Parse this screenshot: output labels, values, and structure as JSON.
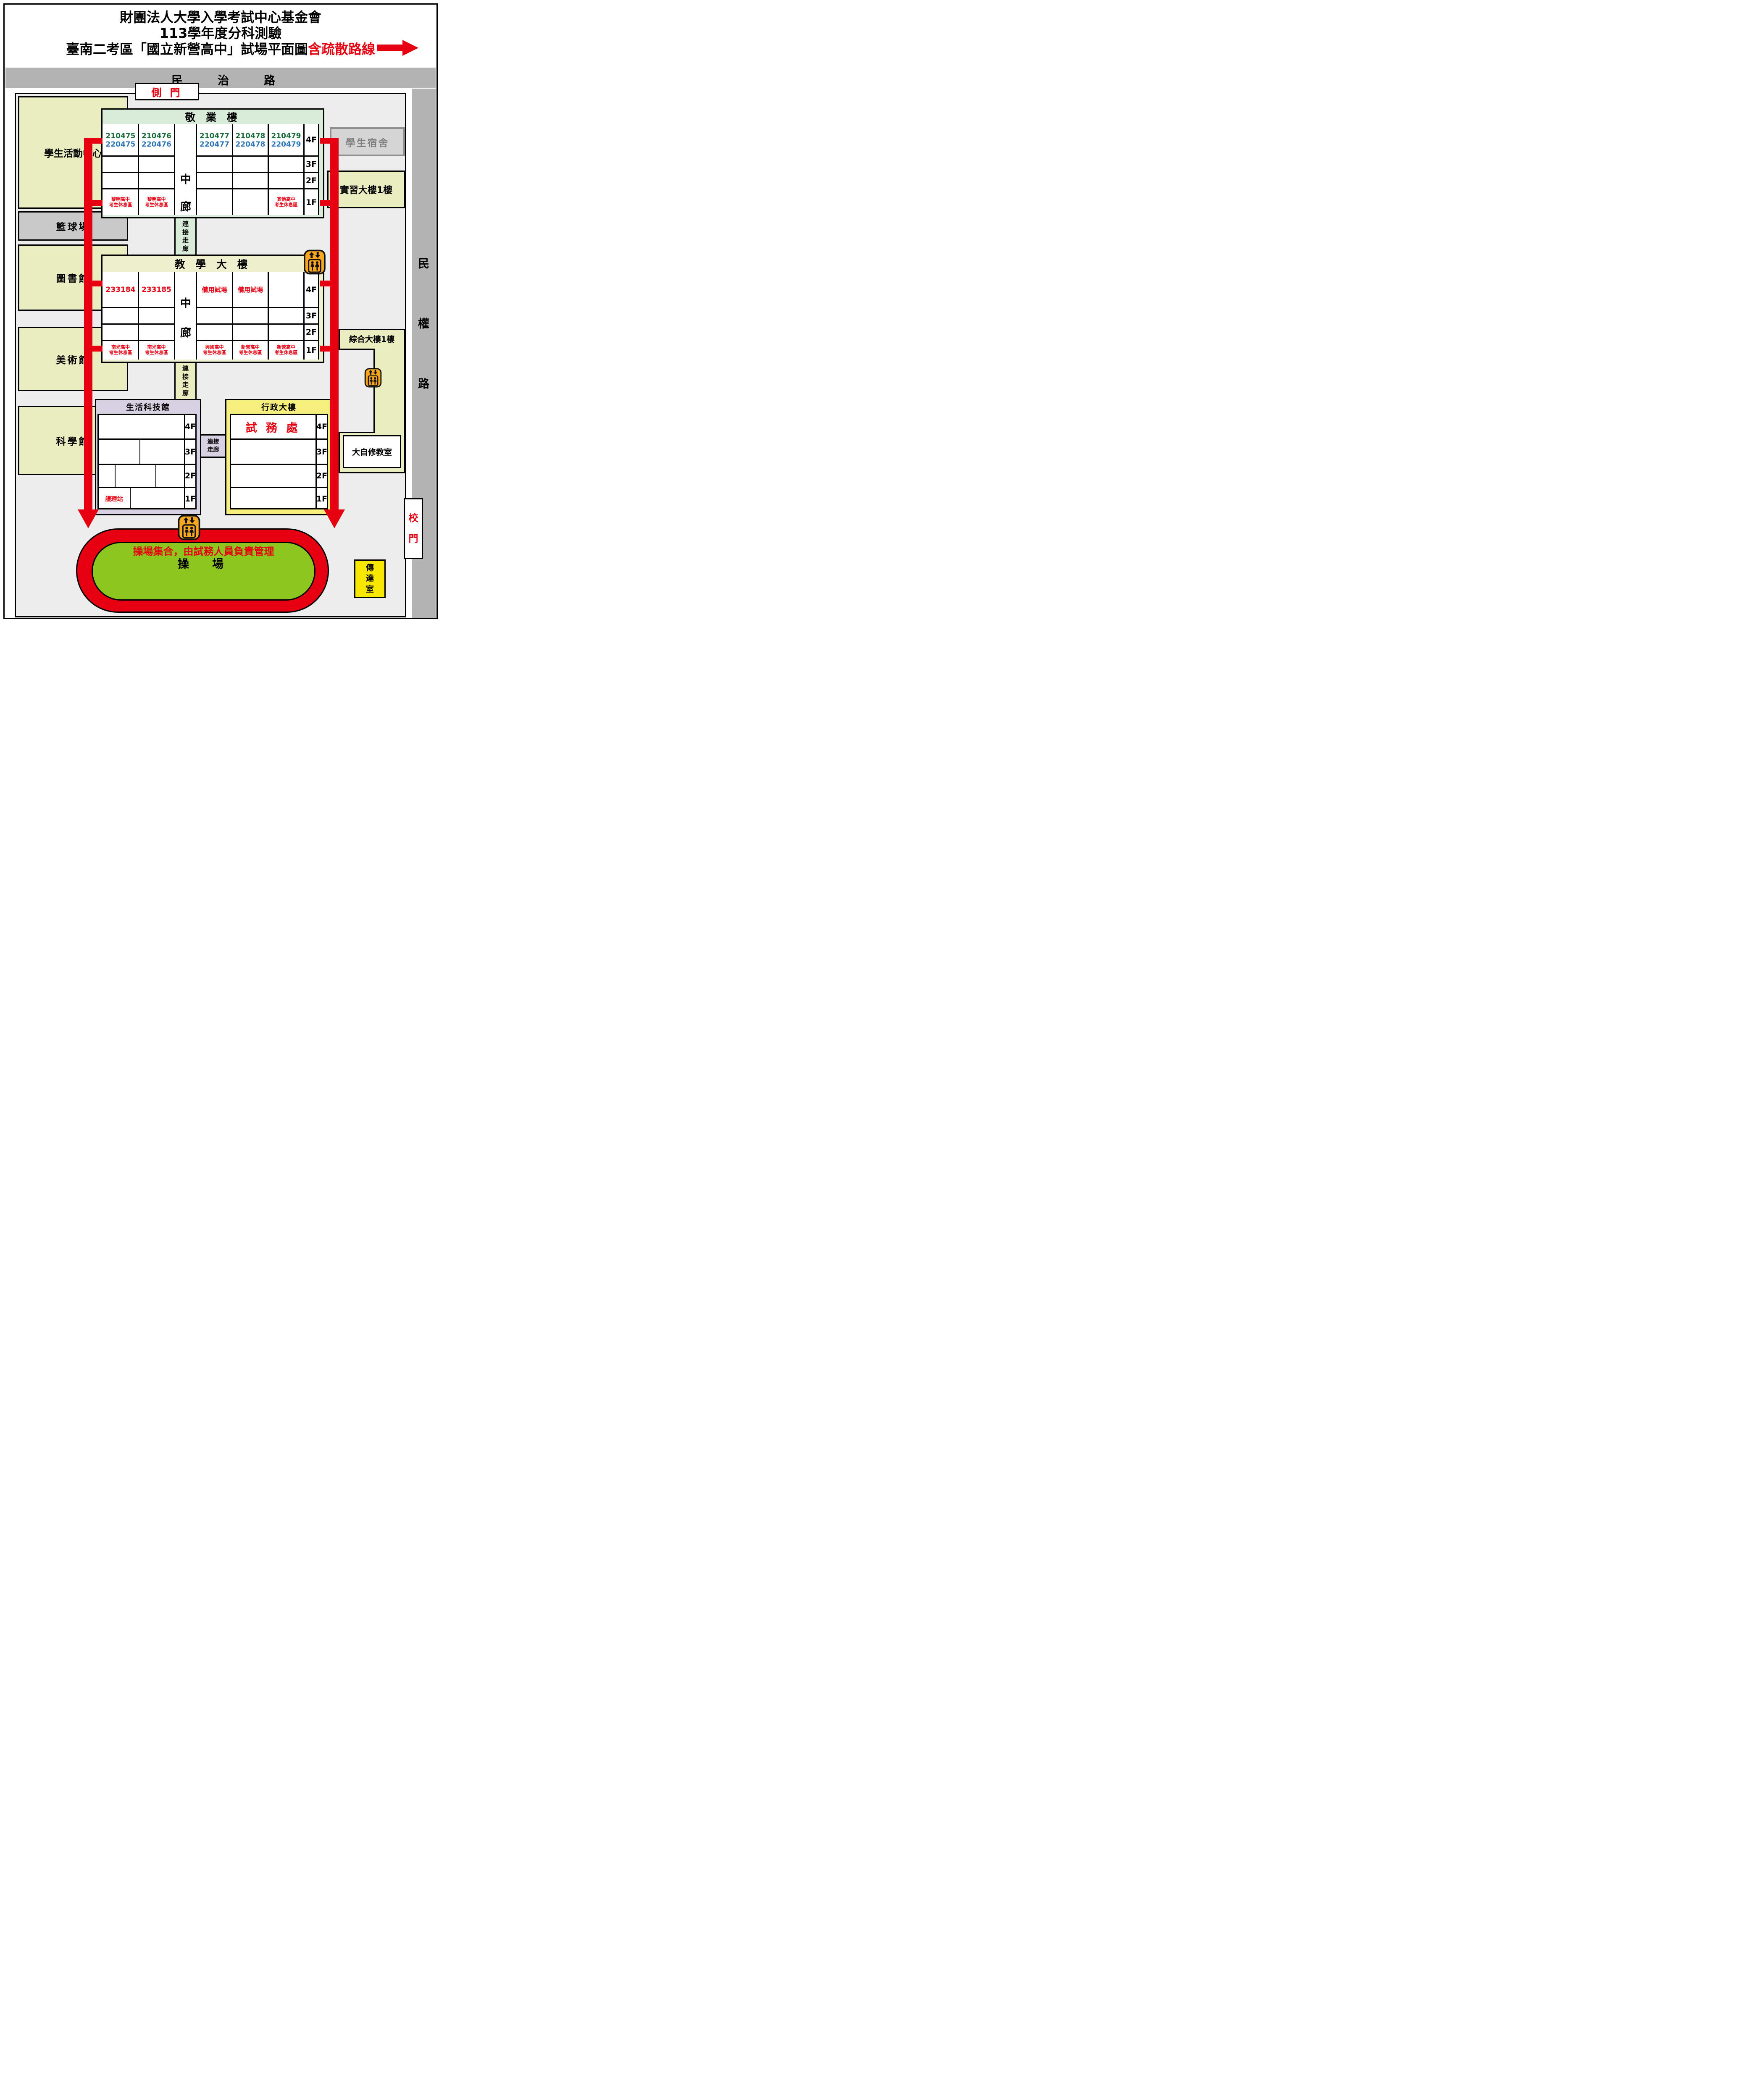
{
  "title": {
    "line1": "財團法人大學入學考試中心基金會",
    "line2": "113學年度分科測驗",
    "line3_black": "臺南二考區「國立新營高中」試場平面圖",
    "line3_red": "含疏散路線"
  },
  "top_road": {
    "c0": "民",
    "c1": "治",
    "c2": "路"
  },
  "right_road": {
    "c0": "民",
    "c1": "權",
    "c2": "路"
  },
  "side_gate": {
    "label": "側  門"
  },
  "main_gate": {
    "c0": "校",
    "c1": "門"
  },
  "left_buildings": {
    "activity_center": "學生活動中心",
    "basketball": "籃球場",
    "library": "圖書館",
    "art": "美術館",
    "science": "科學館"
  },
  "dorm": "學生宿舍",
  "shixi": "實習大樓1樓",
  "zonghe": "綜合大樓1樓",
  "dazixiu": "大自修教室",
  "jingye": {
    "title": "敬 業 樓",
    "mid0": "中",
    "mid1": "廊",
    "floors": [
      "4F",
      "3F",
      "2F",
      "1F"
    ],
    "f4": [
      {
        "g": "210475",
        "b": "220475"
      },
      {
        "g": "210476",
        "b": "220476"
      },
      {
        "g": "210477",
        "b": "220477"
      },
      {
        "g": "210478",
        "b": "220478"
      },
      {
        "g": "210479",
        "b": "220479"
      }
    ],
    "f1": [
      {
        "l1": "黎明高中",
        "l2": "考生休息區"
      },
      {
        "l1": "黎明高中",
        "l2": "考生休息區"
      },
      {
        "l1": "其他高中",
        "l2": "考生休息區"
      }
    ]
  },
  "jiaoxue": {
    "title": "教 學 大 樓",
    "mid0": "中",
    "mid1": "廊",
    "floors": [
      "4F",
      "3F",
      "2F",
      "1F"
    ],
    "f4": [
      "233184",
      "233185",
      "備用試場",
      "備用試場"
    ],
    "f1": [
      {
        "l1": "南光高中",
        "l2": "考生休息區"
      },
      {
        "l1": "南光高中",
        "l2": "考生休息區"
      },
      {
        "l1": "興國高中",
        "l2": "考生休息區"
      },
      {
        "l1": "新營高中",
        "l2": "考生休息區"
      },
      {
        "l1": "新營高中",
        "l2": "考生休息區"
      }
    ]
  },
  "corridor1": {
    "c0": "連",
    "c1": "接",
    "c2": "走",
    "c3": "廊"
  },
  "corridor2": {
    "c0": "連",
    "c1": "接",
    "c2": "走",
    "c3": "廊"
  },
  "corridor3": {
    "l1": "連接",
    "l2": "走廊"
  },
  "shenghuo": {
    "title": "生活科技館",
    "floors": [
      "4F",
      "3F",
      "2F",
      "1F"
    ],
    "nurse": "護理站"
  },
  "xingzheng": {
    "title": "行政大樓",
    "floors": [
      "4F",
      "3F",
      "2F",
      "1F"
    ],
    "office": "試 務 處"
  },
  "track": {
    "notice": "操場集合，由試務人員負責管理",
    "name": "操　場"
  },
  "chuanda": {
    "c0": "傳",
    "c1": "達",
    "c2": "室"
  },
  "colors": {
    "evac_red": "#e60012",
    "field_green": "#8cc61e",
    "road_gray": "#b3b3b3",
    "room_green": "#1a6b3b",
    "room_blue": "#2d74b9",
    "elevator_orange": "#f6a71f"
  }
}
